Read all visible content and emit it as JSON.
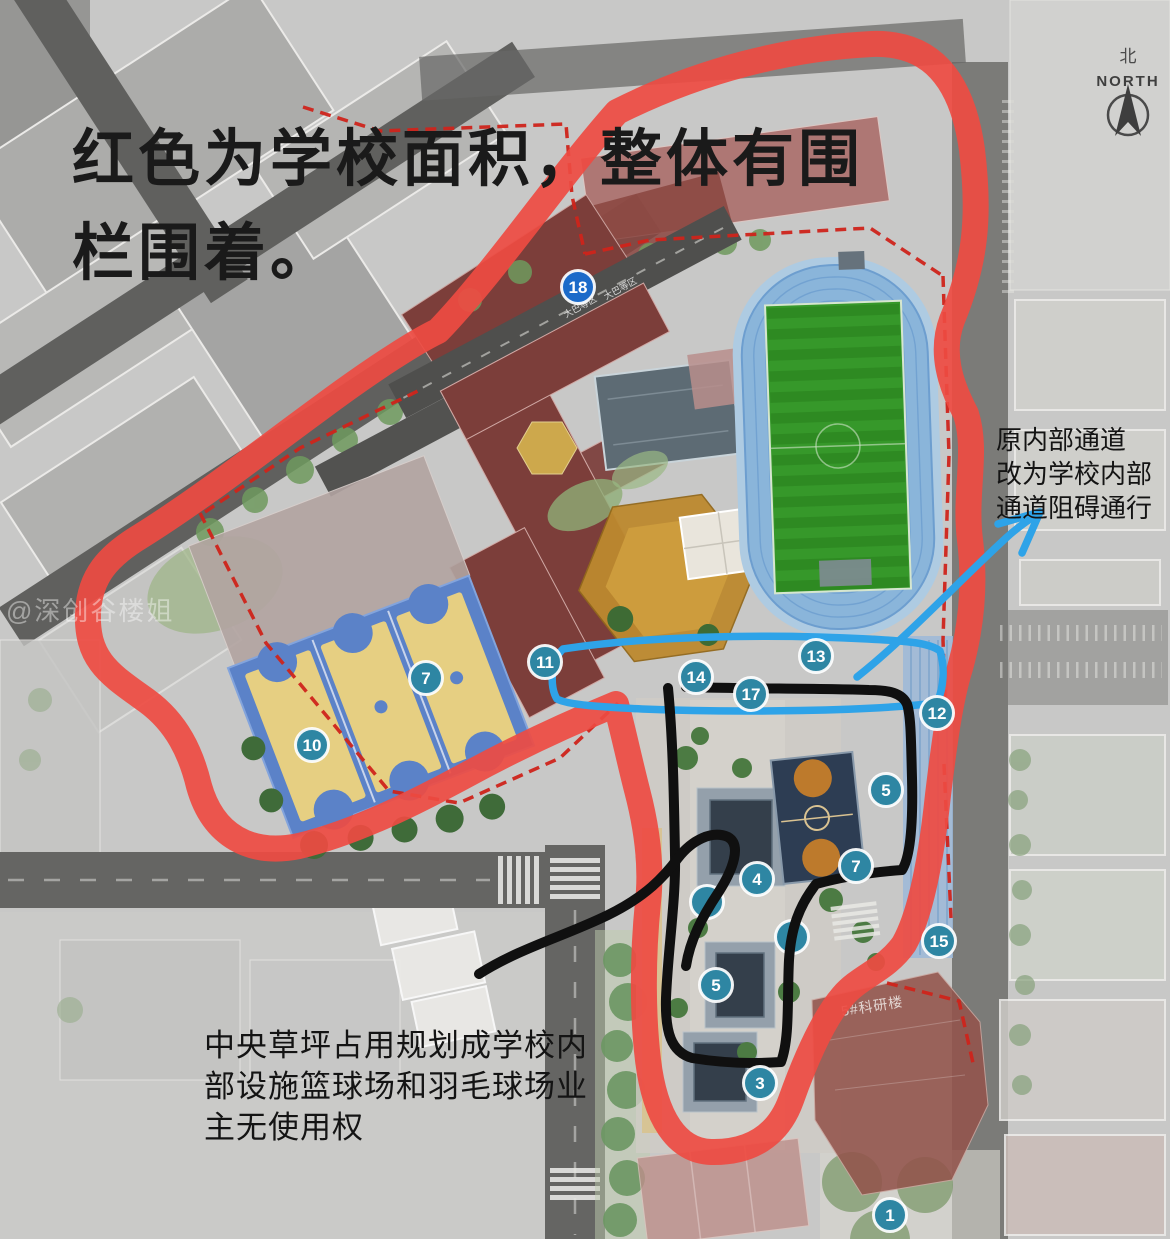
{
  "notes": {
    "top": [
      "红色为学校面积，整体有围",
      "栏围着。"
    ],
    "right": [
      "原内部通道",
      "改为学校内部",
      "通道阻碍通行"
    ],
    "bottom_left": [
      "中央草坪占用规划成学校内",
      "部设施篮球场和羽毛球场业",
      "主无使用权"
    ]
  },
  "compass": {
    "cn": "北",
    "en": "NORTH"
  },
  "watermark": "@深创谷楼姐",
  "map_labels": {
    "building5": "5#科研楼",
    "road": "大巴等区"
  },
  "markers": [
    {
      "label": "18",
      "x": 578,
      "y": 287,
      "variant": "blue"
    },
    {
      "label": "11",
      "x": 545,
      "y": 662
    },
    {
      "label": "14",
      "x": 696,
      "y": 677
    },
    {
      "label": "13",
      "x": 816,
      "y": 656
    },
    {
      "label": "17",
      "x": 751,
      "y": 694
    },
    {
      "label": "12",
      "x": 937,
      "y": 713
    },
    {
      "label": "7",
      "x": 426,
      "y": 678
    },
    {
      "label": "10",
      "x": 312,
      "y": 745
    },
    {
      "label": "5",
      "x": 886,
      "y": 790
    },
    {
      "label": "7",
      "x": 856,
      "y": 866
    },
    {
      "label": "15",
      "x": 939,
      "y": 941
    },
    {
      "label": "4",
      "x": 757,
      "y": 879
    },
    {
      "label": "",
      "x": 707,
      "y": 902,
      "obscured": true
    },
    {
      "label": "",
      "x": 792,
      "y": 937,
      "obscured": true
    },
    {
      "label": "5",
      "x": 716,
      "y": 985
    },
    {
      "label": "3",
      "x": 760,
      "y": 1083
    },
    {
      "label": "1",
      "x": 890,
      "y": 1215
    }
  ],
  "colors": {
    "school_outline": "#ee4b42",
    "boundary_dash": "#cf241b",
    "path_blue": "#2ea3e8",
    "route_black": "#101010",
    "marker_teal": "#2e86a3",
    "marker_blue": "#1b6ac9",
    "track_blue": "#8ab5da",
    "infield_green": "#36982a",
    "court_yellow": "#e6cf82",
    "court_blue": "#5b82c8",
    "building_maroon": "#7c3e3a",
    "playground_orange": "#bd892f"
  }
}
